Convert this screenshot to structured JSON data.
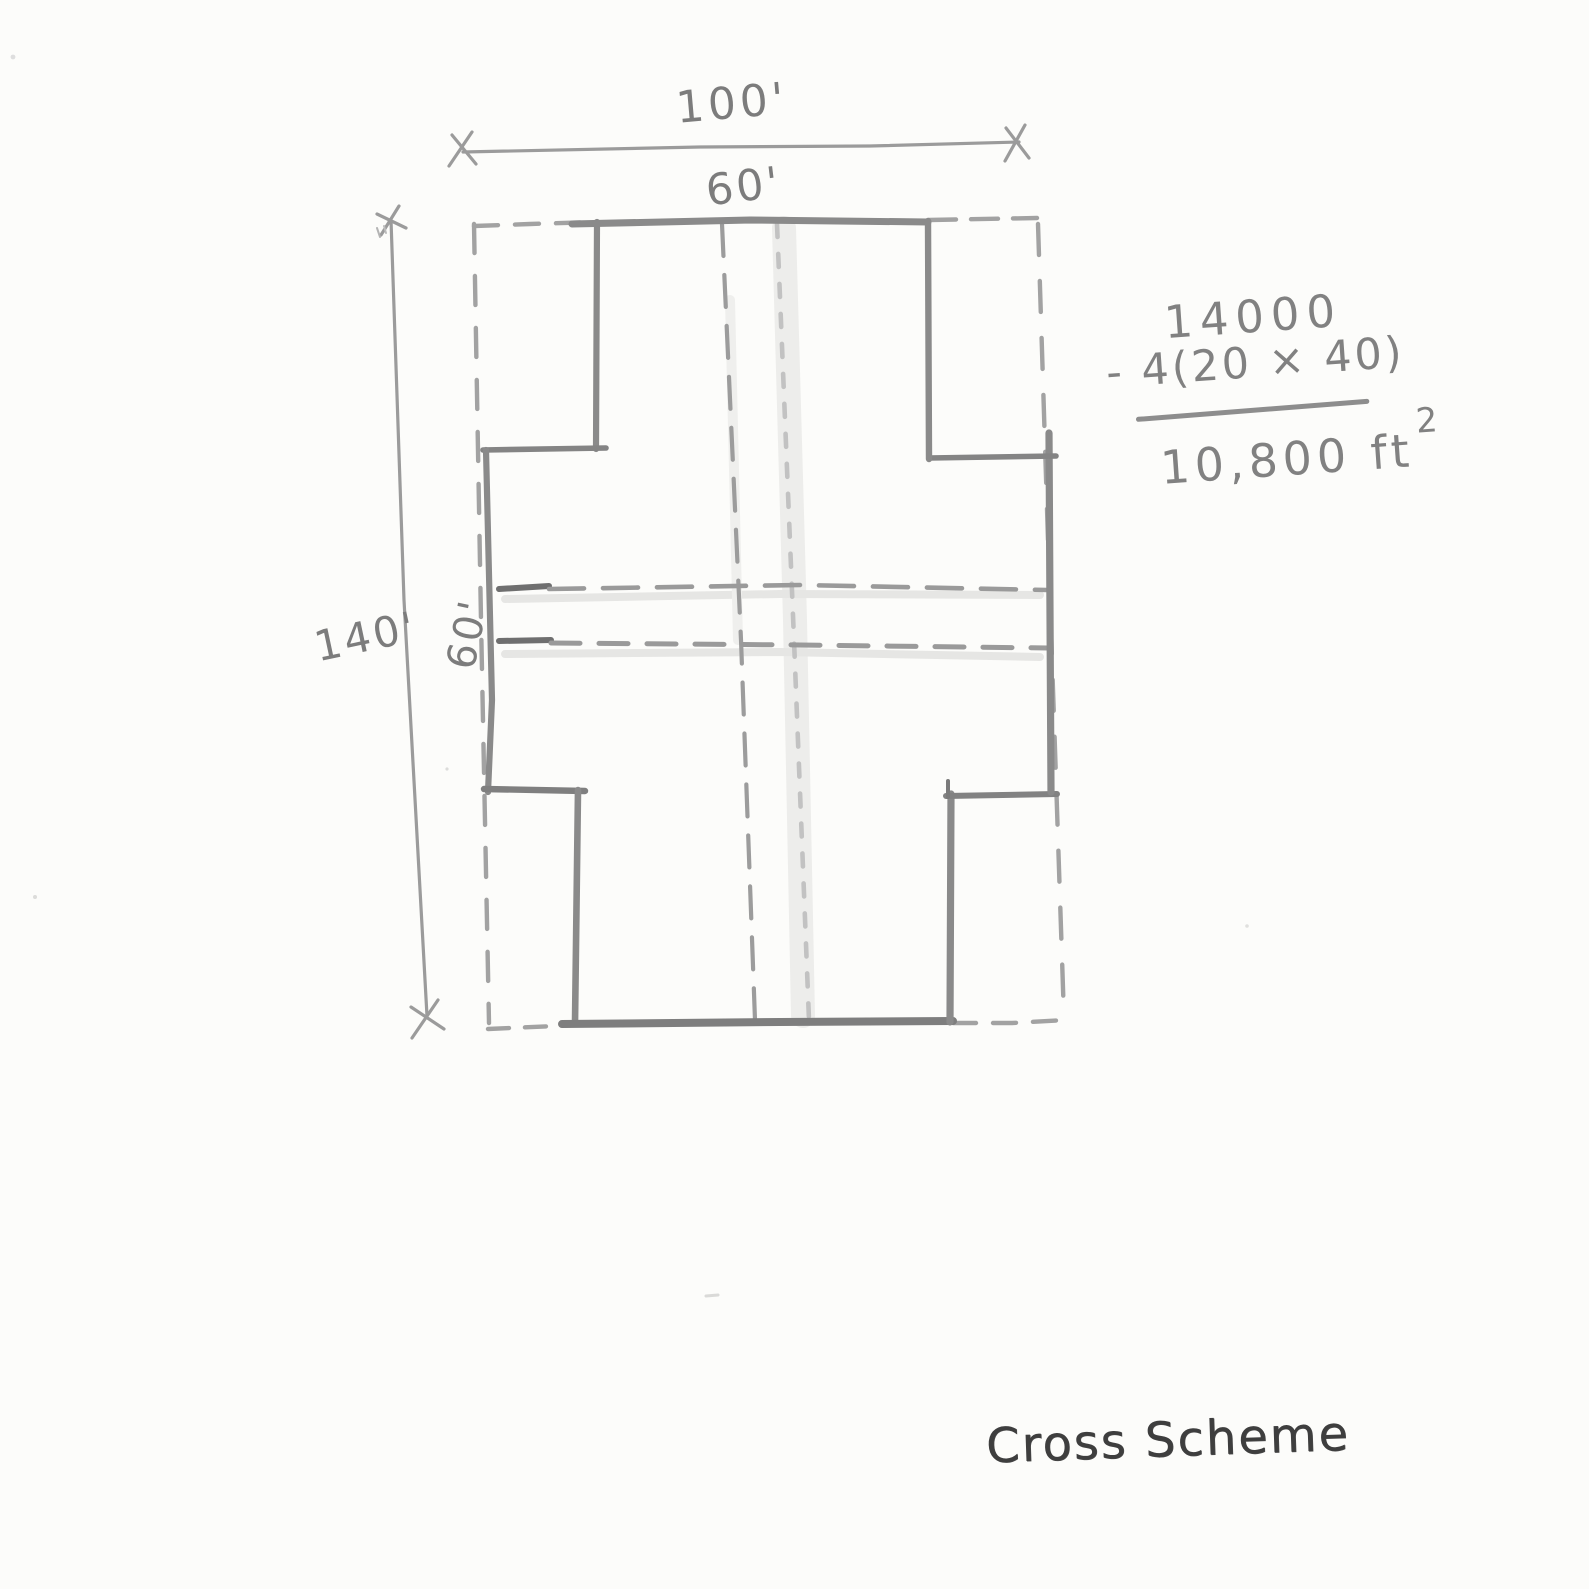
{
  "sketch": {
    "caption": "Cross Scheme",
    "labels": {
      "overall_width": "100'",
      "arm_width_top": "60'",
      "overall_height": "140'",
      "arm_height_left": "60'"
    },
    "calculation": {
      "minuend": "14000",
      "subtrahend": "- 4(20 × 40)",
      "result_value": "10,800 ft",
      "result_exponent": "2"
    },
    "colors": {
      "paper": "#fcfcfa",
      "pencil": "#8a8a8a",
      "pencil_dark": "#6f6f6f",
      "pencil_faint": "#c2c2c2",
      "ink_caption": "#3e3e3e"
    }
  }
}
